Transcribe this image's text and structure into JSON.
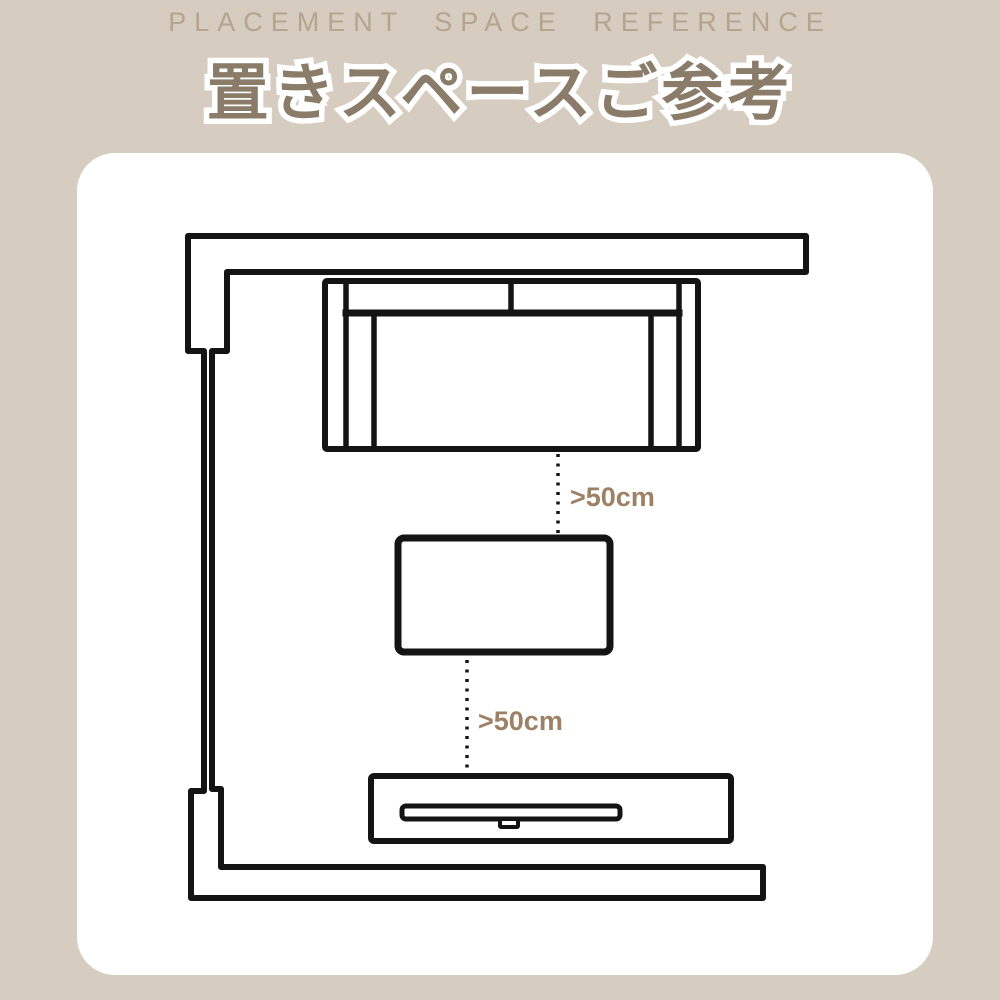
{
  "page": {
    "background_color": "#d6ccbf",
    "card_color": "#ffffff",
    "line_color": "#141414"
  },
  "header": {
    "subtitle_en": "PLACEMENT SPACE REFERENCE",
    "subtitle_color": "#b5a48e",
    "title_jp": "置きスペースご参考",
    "title_color": "#8b7c6a",
    "title_outline_color": "#ffffff"
  },
  "diagram": {
    "kind": "room floor plan",
    "furniture": [
      "wall",
      "sofa",
      "table",
      "tv-stand",
      "tv"
    ],
    "label_color": "#9c8166",
    "spacing_labels": [
      {
        "text": ">50cm"
      },
      {
        "text": ">50cm"
      }
    ]
  }
}
